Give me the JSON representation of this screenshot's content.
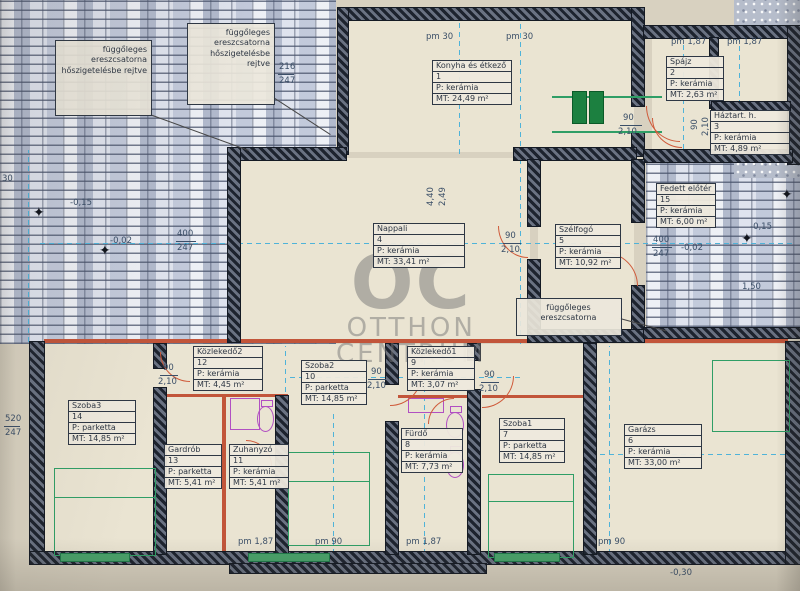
{
  "plan": {
    "watermark": {
      "abbr": "OC",
      "line1": "OTTHON",
      "line2": "CENTRUM"
    },
    "notes": {
      "left": "függőleges ereszcsatorna hőszigetelésbe rejtve",
      "top": "függőleges ereszcsatorna hőszigetelésbe rejtve",
      "middle": "függőleges ereszcsatorna"
    },
    "icons": {
      "level_marker": "✦"
    }
  },
  "rooms": [
    {
      "name": "Konyha és étkező",
      "number": "1",
      "floor": "P: kerámia",
      "area": "MT: 24,49 m²"
    },
    {
      "name": "Spájz",
      "number": "2",
      "floor": "P: kerámia",
      "area": "MT: 2,63 m²"
    },
    {
      "name": "Háztart. h.",
      "number": "3",
      "floor": "P: kerámia",
      "area": "MT: 4,89 m²"
    },
    {
      "name": "Nappali",
      "number": "4",
      "floor": "P: kerámia",
      "area": "MT: 33,41 m²"
    },
    {
      "name": "Szélfogó",
      "number": "5",
      "floor": "P: kerámia",
      "area": "MT: 10,92 m²"
    },
    {
      "name": "Garázs",
      "number": "6",
      "floor": "P: kerámia",
      "area": "MT: 33,00 m²"
    },
    {
      "name": "Szoba1",
      "number": "7",
      "floor": "P: parketta",
      "area": "MT: 14,85 m²"
    },
    {
      "name": "Fürdő",
      "number": "8",
      "floor": "P: kerámia",
      "area": "MT: 7,73 m²"
    },
    {
      "name": "Közlekedő1",
      "number": "9",
      "floor": "P: kerámia",
      "area": "MT: 3,07 m²"
    },
    {
      "name": "Szoba2",
      "number": "10",
      "floor": "P: parketta",
      "area": "MT: 14,85 m²"
    },
    {
      "name": "Zuhanyzó",
      "number": "11",
      "floor": "P: kerámia",
      "area": "MT: 5,41 m²"
    },
    {
      "name": "Közlekedő2",
      "number": "12",
      "floor": "P: kerámia",
      "area": "MT: 4,45 m²"
    },
    {
      "name": "Gardrób",
      "number": "13",
      "floor": "P: parketta",
      "area": "MT: 5,41 m²"
    },
    {
      "name": "Szoba3",
      "number": "14",
      "floor": "P: parketta",
      "area": "MT: 14,85 m²"
    },
    {
      "name": "Fedett előtér",
      "number": "15",
      "floor": "P: kerámia",
      "area": "MT: 6,00 m²"
    }
  ],
  "dims": [
    "pm 30",
    "pm 30",
    "pm 1,87",
    "pm 1,87",
    "90",
    "2,10",
    "90",
    "2,10",
    "90",
    "2,10",
    "400",
    "247",
    "400",
    "247",
    "-0,15",
    "-0,02",
    "-0,15",
    "-0,02",
    "30",
    "-0,30",
    "1,50",
    "pm 1,87",
    "pm 90",
    "pm 1,87",
    "pm 90",
    "90",
    "2,10",
    "90",
    "2,10",
    "90",
    "2,10",
    "4,40",
    "2,49",
    "520",
    "247",
    "216",
    "247"
  ]
}
